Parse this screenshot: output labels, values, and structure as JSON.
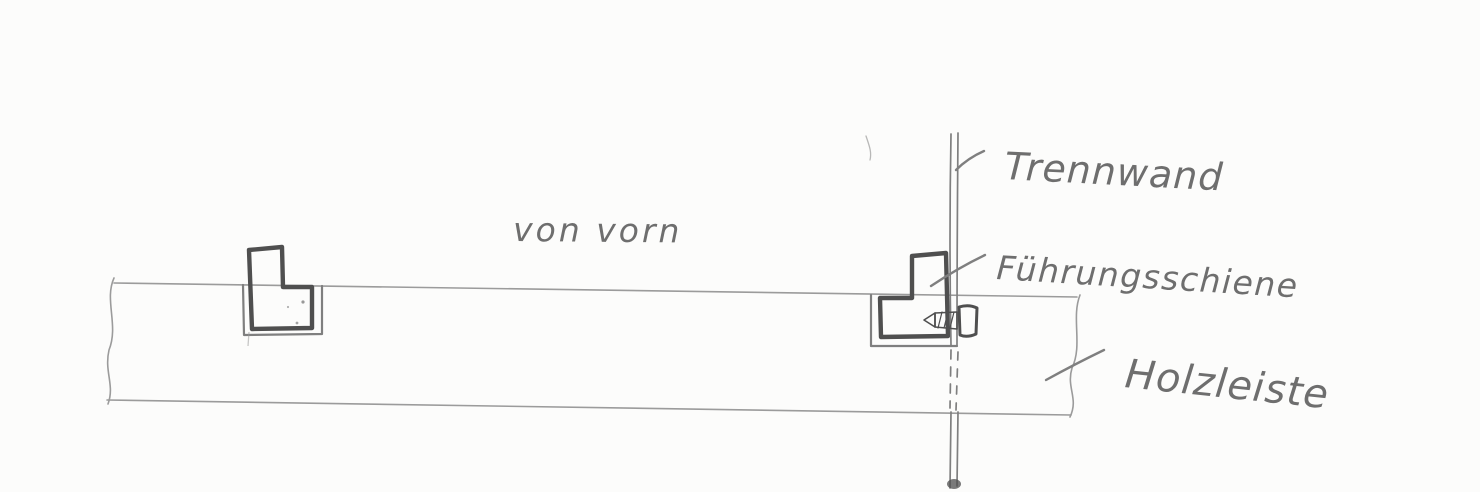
{
  "canvas": {
    "width": 1480,
    "height": 492,
    "paper_color": "#fcfcfb"
  },
  "ink": {
    "pencil_light": "#9b9b9b",
    "pencil_mid": "#7f7f7f",
    "pencil_dark": "#4f4f4f",
    "handwriting": "#6e6e6e"
  },
  "labels": {
    "view_caption": "von vorn",
    "partition_wall": "Trennwand",
    "guide_rail": "Führungsschiene",
    "wood_strip": "Holzleiste"
  }
}
